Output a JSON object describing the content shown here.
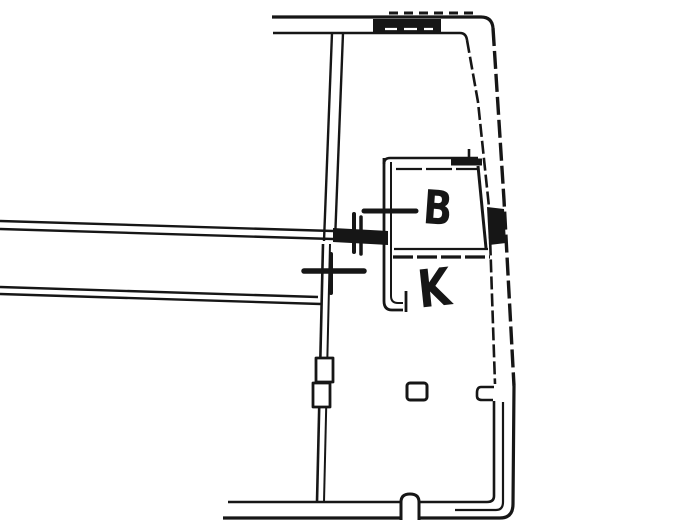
{
  "document": {
    "colors": {
      "ink": "#161616",
      "paper": "#ffffff"
    },
    "rooms": {
      "b": {
        "label": "B"
      },
      "k": {
        "label": "K"
      }
    }
  }
}
